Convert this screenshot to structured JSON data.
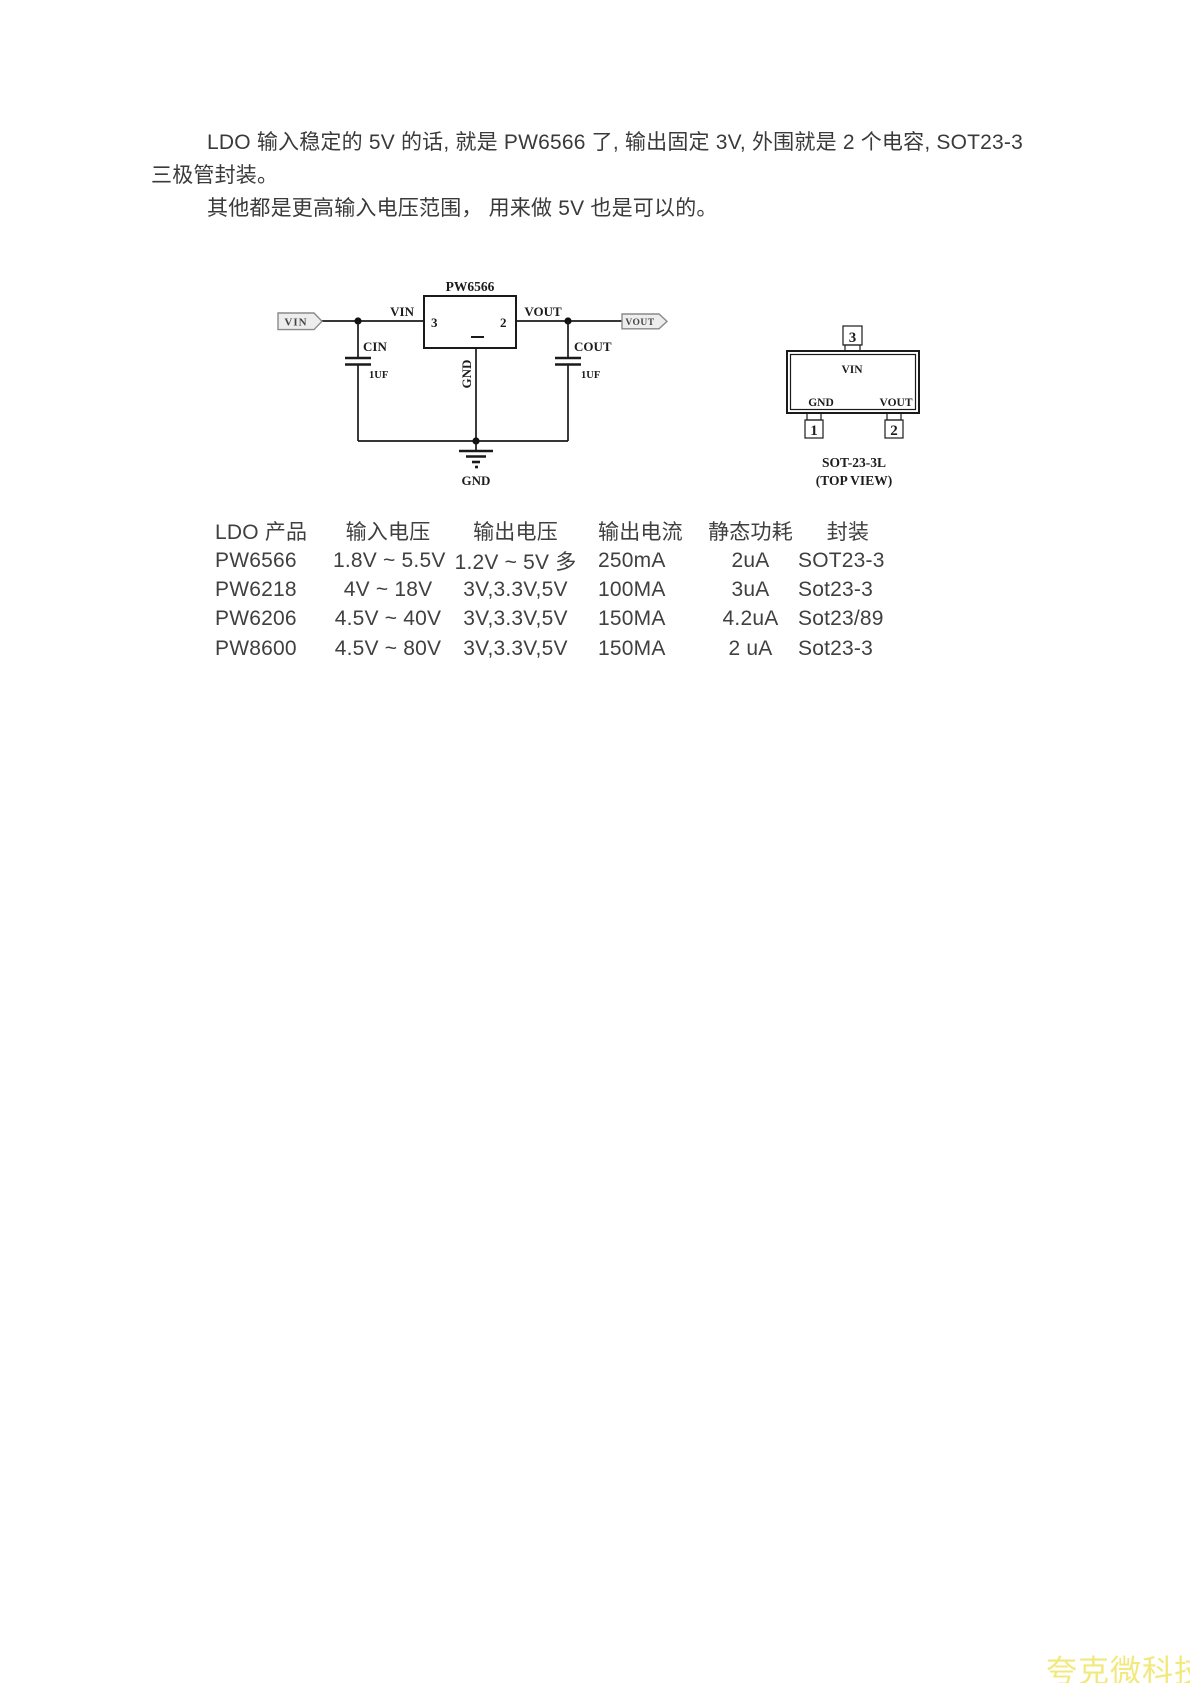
{
  "intro": {
    "line1": "LDO 输入稳定的 5V 的话, 就是 PW6566 了, 输出固定 3V, 外围就是 2 个电容, SOT23-3",
    "line2": "三极管封装。",
    "line3": "其他都是更高输入电压范围， 用来做 5V 也是可以的。"
  },
  "schematic": {
    "ic_name": "PW6566",
    "pin3_number": "3",
    "pin2_number": "2",
    "vin_net_label": "VIN",
    "vout_net_label": "VOUT",
    "vin_port": "VIN",
    "vout_port": "VOUT",
    "cin_name": "CIN",
    "cin_value": "1UF",
    "cout_name": "COUT",
    "cout_value": "1UF",
    "gnd_pin_label": "GND",
    "gnd_symbol_label": "GND"
  },
  "package_diagram": {
    "pin3": "3",
    "pin1": "1",
    "pin2": "2",
    "vin": "VIN",
    "gnd": "GND",
    "vout": "VOUT",
    "package_name": "SOT-23-3L",
    "view_label": "(TOP VIEW)"
  },
  "table": {
    "headers": [
      "LDO 产品",
      "输入电压",
      "输出电压",
      "输出电流",
      "静态功耗",
      "封装"
    ],
    "rows": [
      [
        "PW6566",
        "1.8V ~ 5.5V",
        "1.2V ~ 5V 多",
        "250mA",
        "2uA",
        "SOT23-3"
      ],
      [
        "PW6218",
        "4V ~ 18V",
        "3V,3.3V,5V",
        "100MA",
        "3uA",
        "Sot23-3"
      ],
      [
        "PW6206",
        "4.5V ~ 40V",
        "3V,3.3V,5V",
        "150MA",
        "4.2uA",
        "Sot23/89"
      ],
      [
        "PW8600",
        "4.5V ~ 80V",
        "3V,3.3V,5V",
        "150MA",
        "2 uA",
        "Sot23-3"
      ]
    ]
  },
  "watermark": {
    "text": "夸克微科技"
  }
}
